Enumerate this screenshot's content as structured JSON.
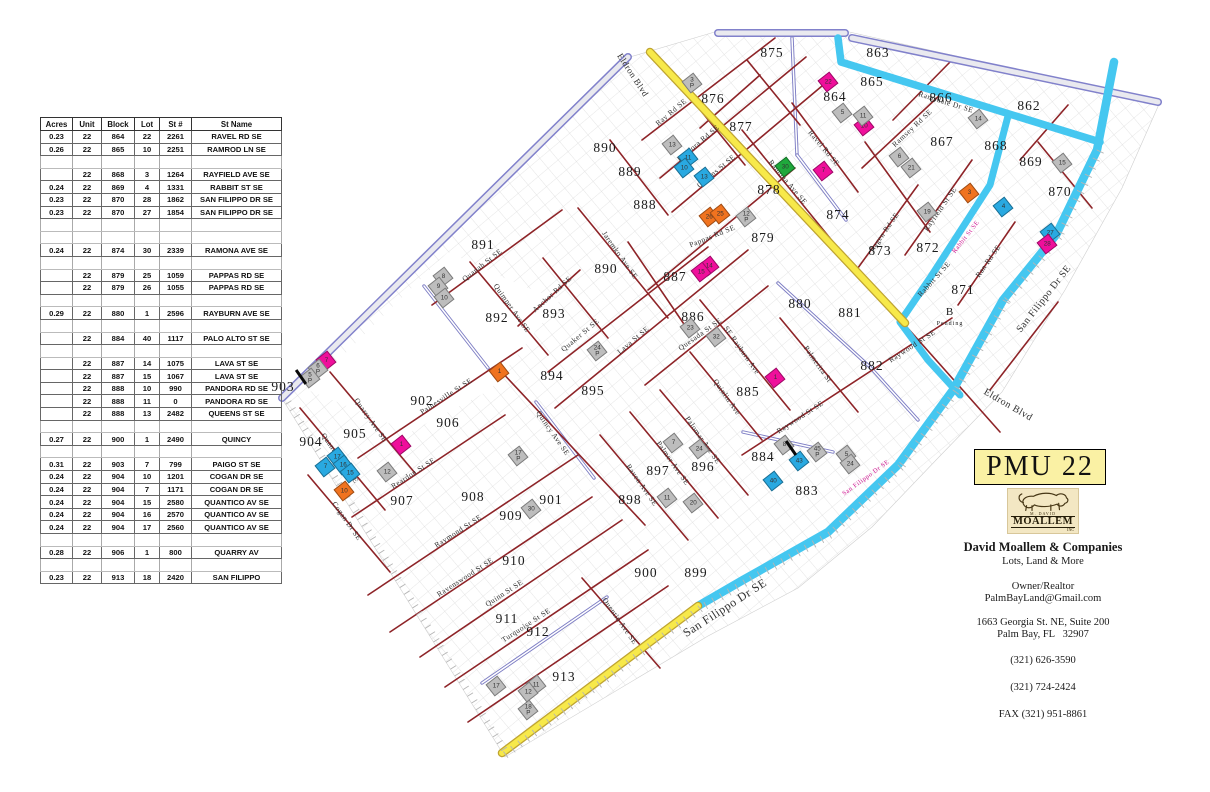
{
  "title": "PMU 22",
  "colors": {
    "road_yellow": "#f7e94a",
    "road_yellow_edge": "#bfa431",
    "road_cyan": "#45c7f0",
    "road_red": "#8e2428",
    "boundary_purple": "#8181cb",
    "boundary_gray": "#e9e9ef",
    "parcel_magenta": "#ef0f9b",
    "parcel_orange": "#f0731f",
    "parcel_cyan": "#29a9e1",
    "parcel_green": "#1fa83c",
    "parcel_gray": "#bdbdbd",
    "grid_gray": "#dcdcdc",
    "badge_yellow": "#faf1a4",
    "onroad_label": "#cf1490"
  },
  "table": {
    "columns": [
      "Acres",
      "Unit",
      "Block",
      "Lot",
      "St #",
      "St Name"
    ],
    "rows": [
      [
        "0.23",
        "22",
        "864",
        "22",
        "2261",
        "RAVEL RD SE"
      ],
      [
        "0.26",
        "22",
        "865",
        "10",
        "2251",
        "RAMROD LN SE"
      ],
      null,
      [
        "",
        "22",
        "868",
        "3",
        "1264",
        "RAYFIELD AVE SE"
      ],
      [
        "0.24",
        "22",
        "869",
        "4",
        "1331",
        "RABBIT ST  SE"
      ],
      [
        "0.23",
        "22",
        "870",
        "28",
        "1862",
        "SAN FILIPPO DR SE"
      ],
      [
        "0.23",
        "22",
        "870",
        "27",
        "1854",
        "SAN FILIPPO DR  SE"
      ],
      null,
      null,
      [
        "0.24",
        "22",
        "874",
        "30",
        "2339",
        "RAMONA AVE  SE"
      ],
      null,
      [
        "",
        "22",
        "879",
        "25",
        "1059",
        "PAPPAS RD SE"
      ],
      [
        "",
        "22",
        "879",
        "26",
        "1055",
        "PAPPAS RD SE"
      ],
      null,
      [
        "0.29",
        "22",
        "880",
        "1",
        "2596",
        "RAYBURN AVE SE"
      ],
      null,
      [
        "",
        "22",
        "884",
        "40",
        "1117",
        "PALO ALTO ST  SE"
      ],
      null,
      [
        "",
        "22",
        "887",
        "14",
        "1075",
        "LAVA ST  SE"
      ],
      [
        "",
        "22",
        "887",
        "15",
        "1067",
        "LAVA ST  SE"
      ],
      [
        "",
        "22",
        "888",
        "10",
        "990",
        "PANDORA RD  SE"
      ],
      [
        "",
        "22",
        "888",
        "11",
        "0",
        "PANDORA RD SE"
      ],
      [
        "",
        "22",
        "888",
        "13",
        "2482",
        "QUEENS ST SE"
      ],
      null,
      [
        "0.27",
        "22",
        "900",
        "1",
        "2490",
        "QUINCY"
      ],
      null,
      [
        "0.31",
        "22",
        "903",
        "7",
        "799",
        "PAIGO ST  SE"
      ],
      [
        "0.24",
        "22",
        "904",
        "10",
        "1201",
        "COGAN DR SE"
      ],
      [
        "0.24",
        "22",
        "904",
        "7",
        "1171",
        "COGAN DR  SE"
      ],
      [
        "0.24",
        "22",
        "904",
        "15",
        "2580",
        "QUANTICO AV  SE"
      ],
      [
        "0.24",
        "22",
        "904",
        "16",
        "2570",
        "QUANTICO AV  SE"
      ],
      [
        "0.24",
        "22",
        "904",
        "17",
        "2560",
        "QUANTICO AV  SE"
      ],
      null,
      [
        "0.28",
        "22",
        "906",
        "1",
        "800",
        "QUARRY AV"
      ],
      null,
      [
        "0.23",
        "22",
        "913",
        "18",
        "2420",
        "SAN FILIPPO"
      ]
    ]
  },
  "map": {
    "block_labels": [
      {
        "t": "875",
        "x": 772,
        "y": 53
      },
      {
        "t": "863",
        "x": 878,
        "y": 53
      },
      {
        "t": "864",
        "x": 835,
        "y": 97
      },
      {
        "t": "865",
        "x": 872,
        "y": 82
      },
      {
        "t": "866",
        "x": 941,
        "y": 98
      },
      {
        "t": "862",
        "x": 1029,
        "y": 106
      },
      {
        "t": "867",
        "x": 942,
        "y": 142
      },
      {
        "t": "868",
        "x": 996,
        "y": 146
      },
      {
        "t": "869",
        "x": 1031,
        "y": 162
      },
      {
        "t": "870",
        "x": 1060,
        "y": 192
      },
      {
        "t": "872",
        "x": 928,
        "y": 248
      },
      {
        "t": "873",
        "x": 880,
        "y": 251
      },
      {
        "t": "871",
        "x": 963,
        "y": 290
      },
      {
        "t": "876",
        "x": 713,
        "y": 99
      },
      {
        "t": "877",
        "x": 741,
        "y": 127
      },
      {
        "t": "878",
        "x": 769,
        "y": 190
      },
      {
        "t": "879",
        "x": 763,
        "y": 238
      },
      {
        "t": "874",
        "x": 838,
        "y": 215
      },
      {
        "t": "890",
        "x": 605,
        "y": 148
      },
      {
        "t": "889",
        "x": 630,
        "y": 172
      },
      {
        "t": "888",
        "x": 645,
        "y": 205
      },
      {
        "t": "890",
        "x": 606,
        "y": 269
      },
      {
        "t": "887",
        "x": 675,
        "y": 277
      },
      {
        "t": "886",
        "x": 693,
        "y": 317
      },
      {
        "t": "880",
        "x": 800,
        "y": 304
      },
      {
        "t": "881",
        "x": 850,
        "y": 313
      },
      {
        "t": "882",
        "x": 872,
        "y": 366
      },
      {
        "t": "885",
        "x": 748,
        "y": 392
      },
      {
        "t": "884",
        "x": 763,
        "y": 457
      },
      {
        "t": "883",
        "x": 807,
        "y": 491
      },
      {
        "t": "891",
        "x": 483,
        "y": 245
      },
      {
        "t": "892",
        "x": 497,
        "y": 318
      },
      {
        "t": "893",
        "x": 554,
        "y": 314
      },
      {
        "t": "894",
        "x": 552,
        "y": 376
      },
      {
        "t": "895",
        "x": 593,
        "y": 391
      },
      {
        "t": "896",
        "x": 703,
        "y": 467
      },
      {
        "t": "897",
        "x": 658,
        "y": 471
      },
      {
        "t": "898",
        "x": 630,
        "y": 500
      },
      {
        "t": "901",
        "x": 551,
        "y": 500
      },
      {
        "t": "900",
        "x": 646,
        "y": 573
      },
      {
        "t": "899",
        "x": 696,
        "y": 573
      },
      {
        "t": "902",
        "x": 422,
        "y": 401
      },
      {
        "t": "906",
        "x": 448,
        "y": 423
      },
      {
        "t": "905",
        "x": 355,
        "y": 434
      },
      {
        "t": "904",
        "x": 311,
        "y": 442
      },
      {
        "t": "903",
        "x": 283,
        "y": 387
      },
      {
        "t": "907",
        "x": 402,
        "y": 501
      },
      {
        "t": "908",
        "x": 473,
        "y": 497
      },
      {
        "t": "909",
        "x": 511,
        "y": 516
      },
      {
        "t": "910",
        "x": 514,
        "y": 561
      },
      {
        "t": "911",
        "x": 507,
        "y": 619
      },
      {
        "t": "912",
        "x": 538,
        "y": 632
      },
      {
        "t": "913",
        "x": 564,
        "y": 677
      },
      {
        "t": "B",
        "x": 950,
        "y": 312,
        "s": 11
      },
      {
        "t": "Pending",
        "x": 950,
        "y": 324,
        "s": 6
      }
    ],
    "street_labels": [
      {
        "t": "Eldron Blvd",
        "x": 633,
        "y": 75,
        "r": 57,
        "s": 9
      },
      {
        "t": "Ray Rd SE",
        "x": 671,
        "y": 112,
        "r": -40
      },
      {
        "t": "Pandora Rd SE",
        "x": 698,
        "y": 143,
        "r": -40
      },
      {
        "t": "Queens St SE",
        "x": 716,
        "y": 171,
        "r": -40
      },
      {
        "t": "Pappas Rd SE",
        "x": 712,
        "y": 236,
        "r": -22
      },
      {
        "t": "Ramona Ave SE",
        "x": 788,
        "y": 182,
        "r": 50
      },
      {
        "t": "Ravel Rd SE",
        "x": 824,
        "y": 148,
        "r": 50
      },
      {
        "t": "Jaremko Ave SE",
        "x": 620,
        "y": 255,
        "r": 55
      },
      {
        "t": "Ramsdale Dr SE",
        "x": 946,
        "y": 102,
        "r": 17
      },
      {
        "t": "Ramsey Rd SE",
        "x": 912,
        "y": 128,
        "r": -43
      },
      {
        "t": "Rayfield St SE",
        "x": 940,
        "y": 209,
        "r": -55
      },
      {
        "t": "Ragen Rd SE",
        "x": 884,
        "y": 232,
        "r": -55
      },
      {
        "t": "Rabbit St SE",
        "x": 934,
        "y": 279,
        "r": -48
      },
      {
        "t": "Rabbit St SE",
        "x": 966,
        "y": 237,
        "r": -52,
        "s": 6.5,
        "c": "#cf1490"
      },
      {
        "t": "Ran Rd SE",
        "x": 988,
        "y": 261,
        "r": -55
      },
      {
        "t": "San Filippo Dr SE",
        "x": 1044,
        "y": 299,
        "r": -52,
        "s": 10
      },
      {
        "t": "San Filippo Dr SE",
        "x": 866,
        "y": 478,
        "r": -36,
        "s": 6.5,
        "c": "#cf1490"
      },
      {
        "t": "Eldron Blvd",
        "x": 1008,
        "y": 405,
        "r": 30,
        "s": 10
      },
      {
        "t": "Quanah St SE",
        "x": 482,
        "y": 265,
        "r": -38
      },
      {
        "t": "Quimper Ave SE",
        "x": 512,
        "y": 308,
        "r": 55
      },
      {
        "t": "Anchor Rd SE",
        "x": 552,
        "y": 294,
        "r": -42
      },
      {
        "t": "Quaker St SE",
        "x": 580,
        "y": 335,
        "r": -40
      },
      {
        "t": "Lava St SE",
        "x": 633,
        "y": 340,
        "r": -40
      },
      {
        "t": "Quesada St SE",
        "x": 700,
        "y": 334,
        "r": -35
      },
      {
        "t": "SE Rayburn Ave",
        "x": 742,
        "y": 350,
        "r": 55
      },
      {
        "t": "Quinlin Ave",
        "x": 727,
        "y": 397,
        "r": 55
      },
      {
        "t": "Palmerita St",
        "x": 818,
        "y": 364,
        "r": 55
      },
      {
        "t": "Raywood St SE",
        "x": 800,
        "y": 417,
        "r": -33
      },
      {
        "t": "Raywood St SE",
        "x": 912,
        "y": 346,
        "r": -33
      },
      {
        "t": "Quincy Ave SE",
        "x": 553,
        "y": 433,
        "r": 55
      },
      {
        "t": "Painesville St SE",
        "x": 446,
        "y": 396,
        "r": -33
      },
      {
        "t": "Reardon St SE",
        "x": 413,
        "y": 473,
        "r": -33
      },
      {
        "t": "Quarry Ave SE",
        "x": 371,
        "y": 420,
        "r": 55
      },
      {
        "t": "Quantico Ave SE",
        "x": 340,
        "y": 458,
        "r": 55
      },
      {
        "t": "Cogan Dr SE",
        "x": 347,
        "y": 521,
        "r": 55
      },
      {
        "t": "Raymond St SE",
        "x": 458,
        "y": 531,
        "r": -33
      },
      {
        "t": "Ravenswood St SE",
        "x": 465,
        "y": 577,
        "r": -33
      },
      {
        "t": "Quinn St SE",
        "x": 504,
        "y": 593,
        "r": -33
      },
      {
        "t": "Turquoise St SE",
        "x": 526,
        "y": 625,
        "r": -33
      },
      {
        "t": "Quentin Ave SE",
        "x": 620,
        "y": 621,
        "r": 55
      },
      {
        "t": "Raven Ave SE",
        "x": 642,
        "y": 485,
        "r": 55
      },
      {
        "t": "Palmer Ave SE",
        "x": 673,
        "y": 463,
        "r": 55
      },
      {
        "t": "Palomar Ave SE",
        "x": 703,
        "y": 440,
        "r": 55
      },
      {
        "t": "San Filippo Dr SE",
        "x": 725,
        "y": 608,
        "r": -33,
        "s": 12
      }
    ],
    "parcels": [
      {
        "t": "22",
        "x": 828,
        "y": 82,
        "c": "magenta"
      },
      {
        "t": "10",
        "x": 864,
        "y": 126,
        "c": "magenta"
      },
      {
        "t": "11",
        "x": 863,
        "y": 116,
        "c": "gray"
      },
      {
        "t": "5",
        "x": 842,
        "y": 113,
        "c": "gray"
      },
      {
        "t": "3",
        "sub": "P",
        "x": 692,
        "y": 83,
        "c": "gray"
      },
      {
        "t": "13",
        "x": 672,
        "y": 145,
        "c": "gray"
      },
      {
        "t": "11",
        "x": 688,
        "y": 158,
        "c": "cyan"
      },
      {
        "t": "10",
        "x": 684,
        "y": 168,
        "c": "cyan"
      },
      {
        "t": "13",
        "x": 704,
        "y": 177,
        "c": "cyan"
      },
      {
        "t": "30",
        "x": 785,
        "y": 167,
        "c": "green"
      },
      {
        "t": "7",
        "x": 823,
        "y": 171,
        "c": "magenta"
      },
      {
        "t": "26",
        "x": 709,
        "y": 217,
        "c": "orange"
      },
      {
        "t": "25",
        "x": 720,
        "y": 214,
        "c": "orange"
      },
      {
        "t": "12",
        "sub": "P",
        "x": 746,
        "y": 217,
        "c": "gray"
      },
      {
        "t": "14",
        "x": 709,
        "y": 266,
        "c": "magenta"
      },
      {
        "t": "15",
        "x": 701,
        "y": 272,
        "c": "magenta"
      },
      {
        "t": "14",
        "x": 978,
        "y": 119,
        "c": "gray"
      },
      {
        "t": "6",
        "x": 899,
        "y": 157,
        "c": "gray"
      },
      {
        "t": "21",
        "x": 911,
        "y": 168,
        "c": "gray"
      },
      {
        "t": "15",
        "x": 1062,
        "y": 163,
        "c": "gray"
      },
      {
        "t": "19",
        "x": 927,
        "y": 212,
        "c": "gray"
      },
      {
        "t": "3",
        "x": 969,
        "y": 193,
        "c": "orange"
      },
      {
        "t": "4",
        "x": 1003,
        "y": 207,
        "c": "cyan"
      },
      {
        "t": "27",
        "x": 1050,
        "y": 233,
        "c": "cyan"
      },
      {
        "t": "28",
        "x": 1047,
        "y": 244,
        "c": "magenta"
      },
      {
        "t": "8",
        "x": 443,
        "y": 277,
        "c": "gray"
      },
      {
        "t": "9",
        "x": 438,
        "y": 287,
        "c": "gray"
      },
      {
        "t": "10",
        "x": 444,
        "y": 298,
        "c": "gray"
      },
      {
        "t": "7",
        "x": 326,
        "y": 361,
        "c": "magenta"
      },
      {
        "t": "6",
        "sub": "P",
        "x": 318,
        "y": 369,
        "c": "gray"
      },
      {
        "t": "5",
        "sub": "P",
        "x": 310,
        "y": 378,
        "c": "gray"
      },
      {
        "t": "1",
        "x": 499,
        "y": 372,
        "c": "orange"
      },
      {
        "t": "1",
        "x": 401,
        "y": 445,
        "c": "magenta"
      },
      {
        "t": "24",
        "sub": "P",
        "x": 597,
        "y": 351,
        "c": "gray"
      },
      {
        "t": "23",
        "x": 690,
        "y": 328,
        "c": "gray"
      },
      {
        "t": "32",
        "x": 716,
        "y": 337,
        "c": "gray"
      },
      {
        "t": "1",
        "x": 775,
        "y": 378,
        "c": "magenta"
      },
      {
        "t": "17",
        "x": 337,
        "y": 457,
        "c": "cyan"
      },
      {
        "t": "16",
        "x": 343,
        "y": 465,
        "c": "cyan"
      },
      {
        "t": "15",
        "x": 350,
        "y": 473,
        "c": "cyan"
      },
      {
        "t": "7",
        "x": 325,
        "y": 467,
        "c": "cyan"
      },
      {
        "t": "10",
        "x": 344,
        "y": 491,
        "c": "orange"
      },
      {
        "t": "12",
        "x": 387,
        "y": 472,
        "c": "gray"
      },
      {
        "t": "17",
        "sub": "P",
        "x": 518,
        "y": 456,
        "c": "gray"
      },
      {
        "t": "30",
        "x": 531,
        "y": 509,
        "c": "gray"
      },
      {
        "t": "7",
        "x": 673,
        "y": 443,
        "c": "gray"
      },
      {
        "t": "24",
        "x": 699,
        "y": 449,
        "c": "gray"
      },
      {
        "t": "11",
        "x": 667,
        "y": 498,
        "c": "gray"
      },
      {
        "t": "20",
        "x": 693,
        "y": 503,
        "c": "gray"
      },
      {
        "t": "8",
        "x": 784,
        "y": 445,
        "c": "gray"
      },
      {
        "t": "43",
        "x": 799,
        "y": 461,
        "c": "cyan"
      },
      {
        "t": "40",
        "x": 773,
        "y": 481,
        "c": "cyan"
      },
      {
        "t": "45",
        "sub": "P",
        "x": 817,
        "y": 452,
        "c": "gray"
      },
      {
        "t": "5",
        "x": 846,
        "y": 455,
        "c": "gray"
      },
      {
        "t": "24",
        "x": 850,
        "y": 464,
        "c": "gray"
      },
      {
        "t": "17",
        "x": 496,
        "y": 686,
        "c": "gray"
      },
      {
        "t": "11",
        "x": 536,
        "y": 685,
        "c": "gray"
      },
      {
        "t": "12",
        "x": 528,
        "y": 692,
        "c": "gray"
      },
      {
        "t": "18",
        "sub": "P",
        "x": 528,
        "y": 710,
        "c": "gray"
      }
    ],
    "ticks": [
      {
        "x": 301,
        "y": 377
      },
      {
        "x": 791,
        "y": 448
      }
    ]
  },
  "card": {
    "logo": {
      "top": "M. DAVID",
      "name": "MOALLEM",
      "suffix": "INC"
    },
    "lines": [
      {
        "t": "David Moallem & Companies",
        "s": 12.5,
        "b": true,
        "mt": 6
      },
      {
        "t": "Lots, Land & More",
        "s": 10.5,
        "mt": 1
      },
      {
        "t": "Owner/Realtor",
        "s": 10.5,
        "mt": 14
      },
      {
        "t": "PalmBayLand@Gmail.com",
        "s": 10.5,
        "mt": 1
      },
      {
        "t": "1663 Georgia St. NE, Suite 200",
        "s": 10.5,
        "mt": 13
      },
      {
        "t": "Palm Bay, FL   32907",
        "s": 10.5,
        "mt": 1
      },
      {
        "t": "(321) 626-3590",
        "s": 10.5,
        "mt": 15
      },
      {
        "t": "(321) 724-2424",
        "s": 10.5,
        "mt": 16
      },
      {
        "t": "FAX (321) 951-8861",
        "s": 10.5,
        "mt": 16
      }
    ]
  }
}
